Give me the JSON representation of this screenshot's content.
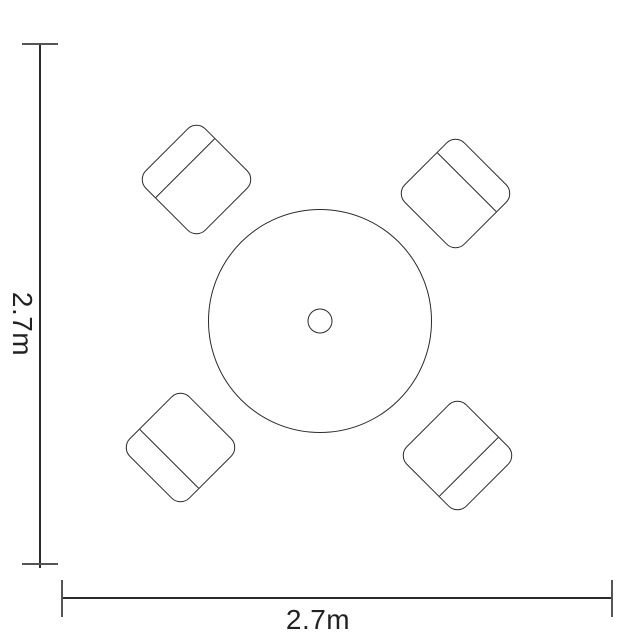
{
  "diagram": {
    "type": "furniture-dimensions-floorplan",
    "description": "Top-down plan view of a round bistro table with centre parasol hole and four chairs angled at the corners",
    "dimensions": {
      "width_label": "2.7m",
      "height_label": "2.7m"
    },
    "furniture": {
      "table_shape": "circle",
      "parasol_hole": true,
      "chair_count": 4,
      "chair_positions": [
        "top-left",
        "top-right",
        "bottom-left",
        "bottom-right"
      ]
    }
  },
  "colors": {
    "stroke": "#2b2b2b",
    "cap": "#555555",
    "text": "#222222",
    "bg": "#ffffff"
  }
}
